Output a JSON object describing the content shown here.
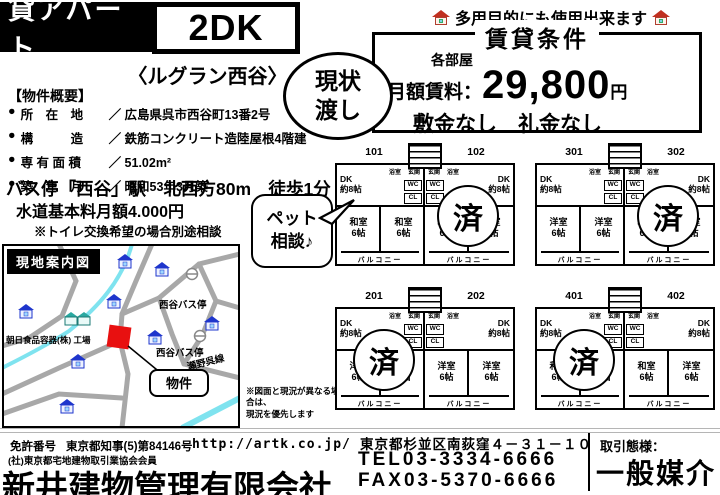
{
  "header": {
    "category": "貸アパート",
    "layout": "2DK",
    "property_name": "〈ルグラン西谷〉",
    "multi_use": "多用目的にも使用出来ます"
  },
  "conditions": {
    "title": "賃貸条件",
    "each_room": "各部屋",
    "rent_label": "月額賃料：",
    "rent_value": "29,800",
    "rent_unit": "円",
    "deposit": "敷金なし　礼金なし",
    "as_is": "現状\n渡し"
  },
  "overview": {
    "title": "【物件概要】",
    "bullet": "●",
    "rows": [
      {
        "label": "所　在　地",
        "value": "／ 広島県呉市西谷町13番2号"
      },
      {
        "label": "構　　　造",
        "value": "／ 鉄筋コンクリート造陸屋根4階建"
      },
      {
        "label": "専 有 面 積",
        "value": "／ 51.02m²"
      },
      {
        "label": "築　年　月",
        "value": "／ 昭和53年3月築"
      }
    ],
    "access": "バス停「西谷」駅　北西方80m　徒歩1分",
    "water_fee": "水道基本料月額4.000円",
    "toilet_note": "※トイレ交換希望の場合別途相談"
  },
  "map": {
    "title": "現地案内図",
    "labels": {
      "bus_stop_1": "西谷バス停",
      "bus_stop_2": "西谷バス停",
      "factory": "朝日食品容器(株) 工場",
      "route": "瀬野呉線",
      "property": "物件"
    }
  },
  "pets": "ペット\n相談♪",
  "floorplans": {
    "sold": "済",
    "note": "※図面と現況が異なる場合は、\n現況を優先します",
    "labels": {
      "dk_full": "DK\n約8帖",
      "bath": "浴室",
      "entrance": "玄関",
      "wc": "WC",
      "cl": "CL",
      "size": "6帖",
      "balcony": "バルコニー"
    },
    "groups": [
      {
        "units": [
          {
            "no": "101",
            "r1": "和室",
            "r2": "和室"
          },
          {
            "no": "102",
            "r1": "和室",
            "r2": "和室"
          }
        ]
      },
      {
        "units": [
          {
            "no": "301",
            "r1": "洋室",
            "r2": "洋室"
          },
          {
            "no": "302",
            "r1": "和室",
            "r2": "洋室"
          }
        ]
      },
      {
        "units": [
          {
            "no": "201",
            "r1": "洋室",
            "r2": "洋室"
          },
          {
            "no": "202",
            "r1": "洋室",
            "r2": "洋室"
          }
        ]
      },
      {
        "units": [
          {
            "no": "401",
            "r1": "和室",
            "r2": "和室"
          },
          {
            "no": "402",
            "r1": "和室",
            "r2": "洋室"
          }
        ]
      }
    ]
  },
  "footer": {
    "license_label": "免許番号",
    "license_no": "東京都知事(5)第84146号",
    "association": "(社)東京都宅地建物取引業協会会員",
    "company": "新井建物管理有限会社",
    "url": "http://artk.co.jp/",
    "address": "東京都杉並区南荻窪４－３１－１０",
    "tel": "TEL03-3334-6666",
    "fax": "FAX03-5370-6666",
    "deal_label": "取引態様：",
    "deal_type": "一般媒介"
  }
}
